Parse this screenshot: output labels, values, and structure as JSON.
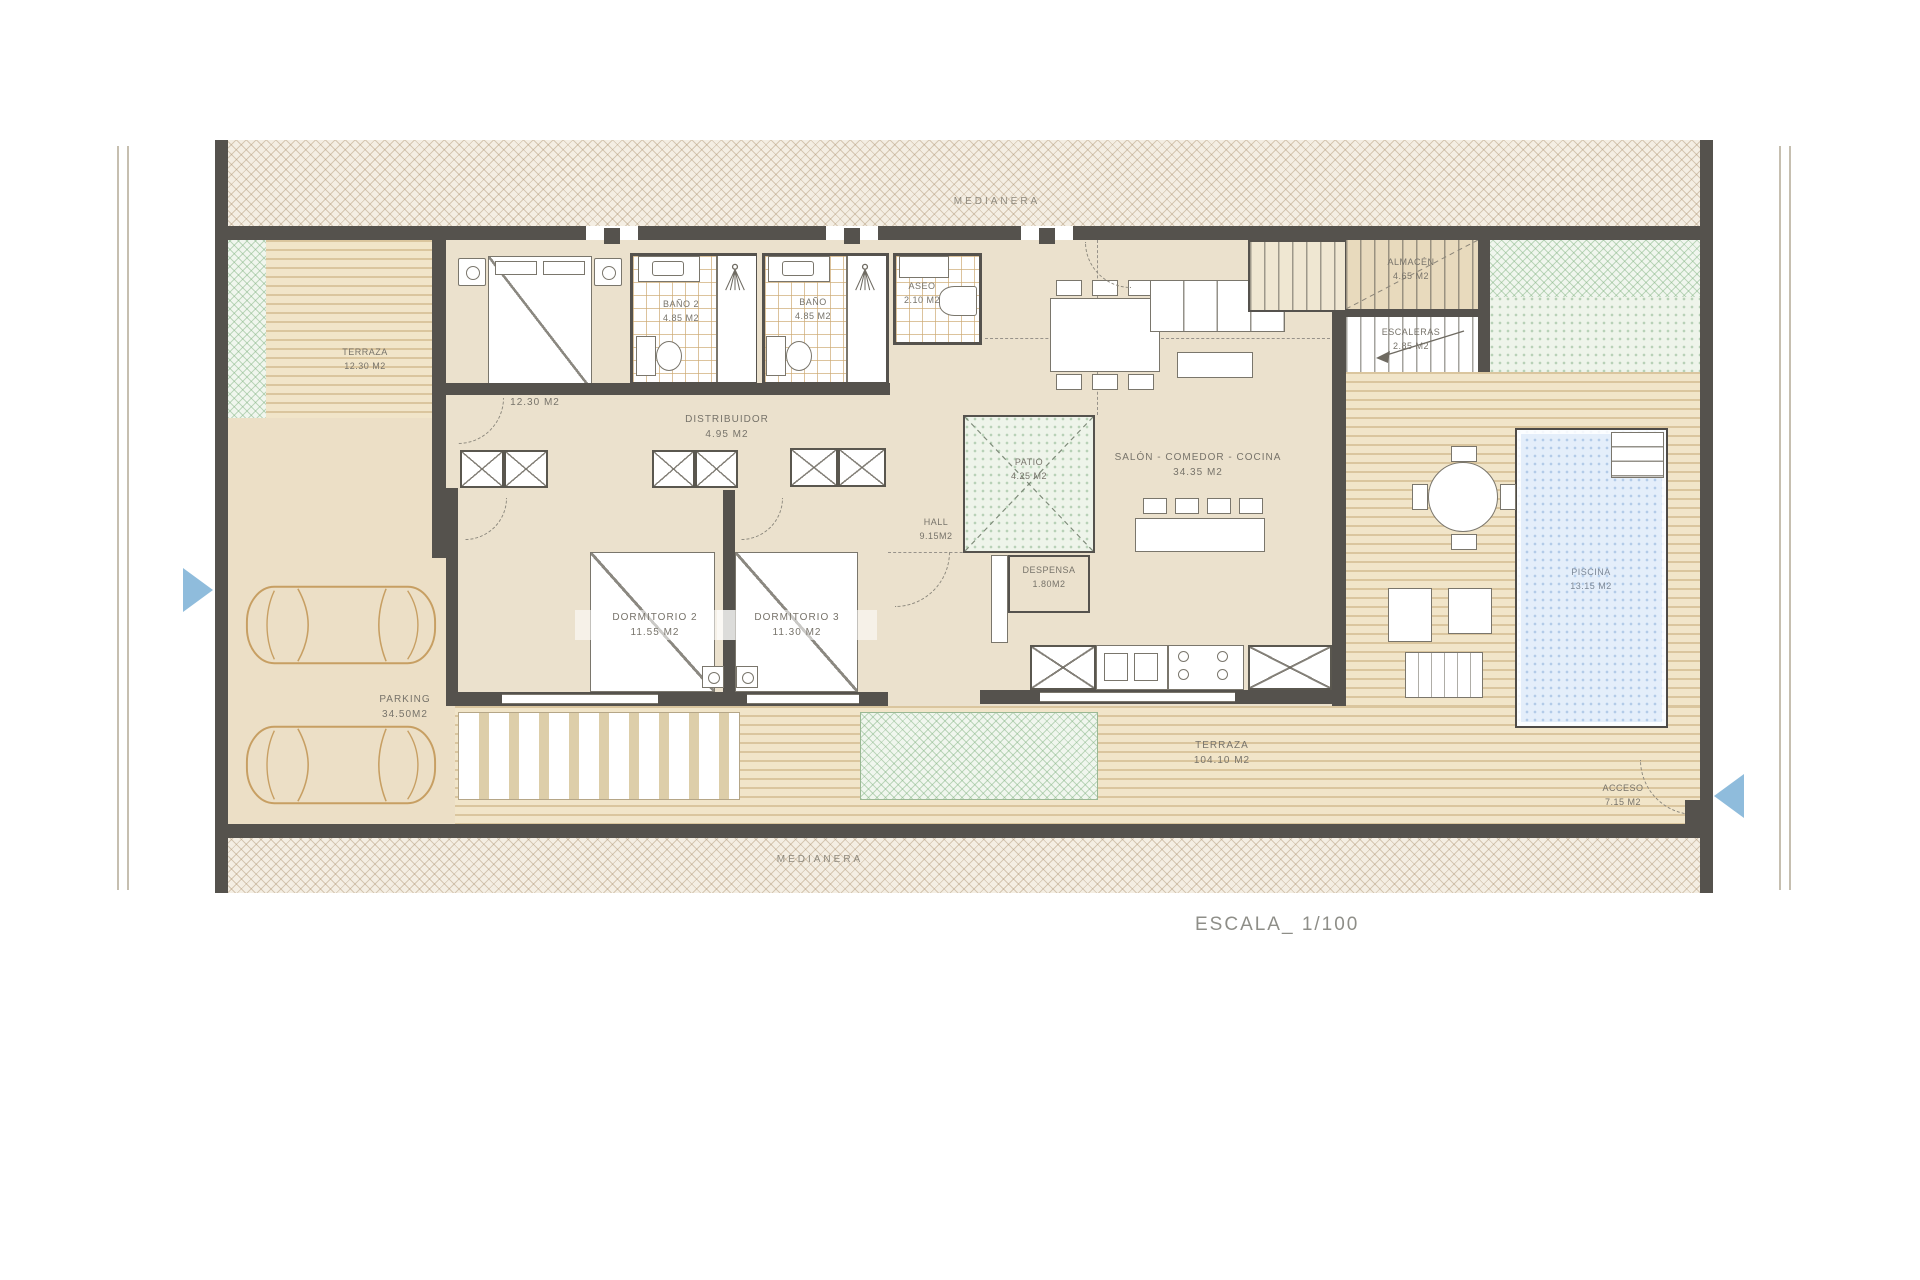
{
  "title_block": {
    "scale": "ESCALA_ 1/100"
  },
  "boundaries": {
    "top": "MEDIANERA",
    "bottom": "MEDIANERA"
  },
  "plan": {
    "rooms": {
      "terraza_left": {
        "name": "TERRAZA",
        "area": "12.30 m2"
      },
      "dormitorio_principal": {
        "name": "DORMITORIO PRINCIPAL",
        "area": "12.30 m2"
      },
      "bano2": {
        "name": "BAÑO 2",
        "area": "4.85 m2"
      },
      "bano": {
        "name": "BAÑO",
        "area": "4.85 m2"
      },
      "aseo": {
        "name": "ASEO",
        "area": "2.10 m2"
      },
      "distribuidor": {
        "name": "DISTRIBUIDOR",
        "area": "4.95 m2"
      },
      "hall": {
        "name": "HALL",
        "area": "9.15m2"
      },
      "patio": {
        "name": "PATIO",
        "area": "4.25 m2"
      },
      "salon": {
        "name": "SALÓN - COMEDOR - COCINA",
        "area": "34.35 m2"
      },
      "despensa": {
        "name": "DESPENSA",
        "area": "1.80m2"
      },
      "dormitorio2": {
        "name": "DORMITORIO 2",
        "area": "11.55 m2"
      },
      "dormitorio3": {
        "name": "DORMITORIO 3",
        "area": "11.30 m2"
      },
      "parking": {
        "name": "PARKING",
        "area": "34.50m2"
      },
      "terraza_main": {
        "name": "TERRAZA",
        "area": "104.10 m2"
      },
      "piscina": {
        "name": "PISCINA",
        "area": "13.15 m2"
      },
      "almacen": {
        "name": "ALMACÉN",
        "area": "4.65 m2"
      },
      "escaleras": {
        "name": "ESCALERAS",
        "area": "2.85 m2"
      },
      "barbacoa": {
        "name": "BARBACOA"
      },
      "acceso": {
        "name": "ACCESO",
        "area": "7.15 m2"
      }
    },
    "icons": {
      "entry_arrow_left": "triangle-pointing-right",
      "entry_arrow_right": "triangle-pointing-left",
      "shower": "shower-spray",
      "barbecue": "grill-circle"
    },
    "colors": {
      "wall": "#55524d",
      "floor": "#ebe1cd",
      "deck": "#f1e5c9",
      "green": "#9cc79c",
      "pool": "#e4eefa",
      "arrow": "#8fbcdc",
      "car_outline": "#c79f63",
      "label_text": "#77736a"
    }
  }
}
